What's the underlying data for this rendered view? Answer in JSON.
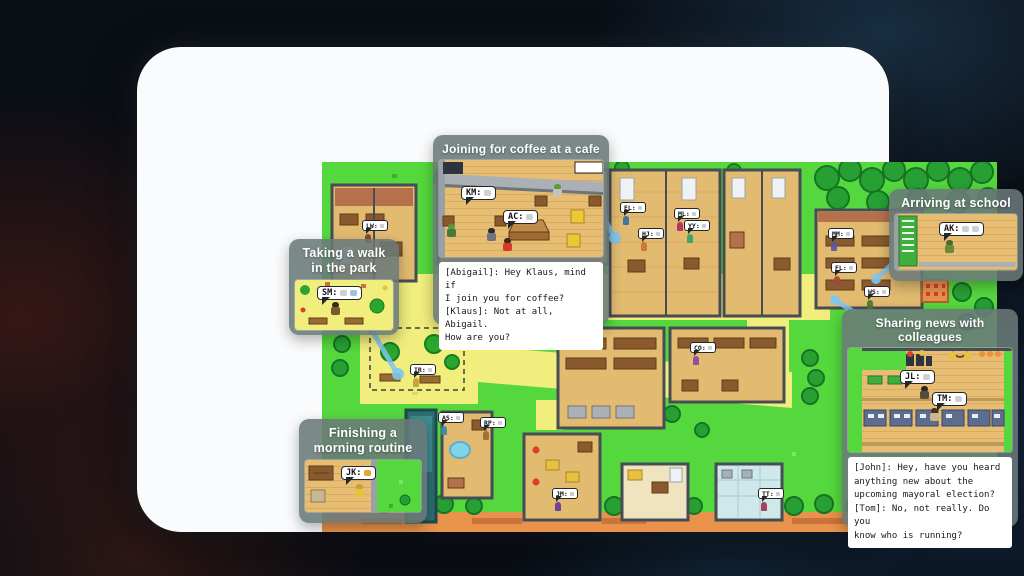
{
  "callouts": {
    "walk": {
      "title": "Taking a walk\nin the park",
      "bubble_label": "SM:"
    },
    "coffee": {
      "title": "Joining for coffee at a cafe",
      "bubble1_label": "KM:",
      "bubble2_label": "AC:",
      "dialogue": "[Abigail]: Hey Klaus, mind if\nI join you for coffee?\n[Klaus]: Not at all, Abigail.\nHow are you?"
    },
    "school": {
      "title": "Arriving at school",
      "bubble_label": "AK:"
    },
    "news": {
      "title": "Sharing news with colleagues",
      "bubble1_label": "JL:",
      "bubble2_label": "TM:",
      "dialogue": "[John]: Hey, have you heard\nanything new about the\nupcoming mayoral election?\n[Tom]: No, not really. Do you\nknow who is running?"
    },
    "morning": {
      "title": "Finishing a\nmorning routine",
      "bubble_label": "JK:"
    }
  },
  "map_bubbles": [
    {
      "label": "LW:"
    },
    {
      "label": "EL:"
    },
    {
      "label": "ML:"
    },
    {
      "label": "YY:"
    },
    {
      "label": "HJ:"
    },
    {
      "label": "MM:"
    },
    {
      "label": "FL:"
    },
    {
      "label": "WS:"
    },
    {
      "label": "IR:"
    },
    {
      "label": "CO:"
    },
    {
      "label": "AS:"
    },
    {
      "label": "RP:"
    },
    {
      "label": "JM:"
    },
    {
      "label": "TT:"
    }
  ],
  "colors": {
    "grass": "#55d83e",
    "path_yellow": "#f1ee7d",
    "callout_gray": "#6a7979",
    "leader_blue": "#7dc6ee",
    "card_white": "#fafbfc",
    "floor_tan": "#e3bb70",
    "dirt_orange": "#e8924b"
  }
}
